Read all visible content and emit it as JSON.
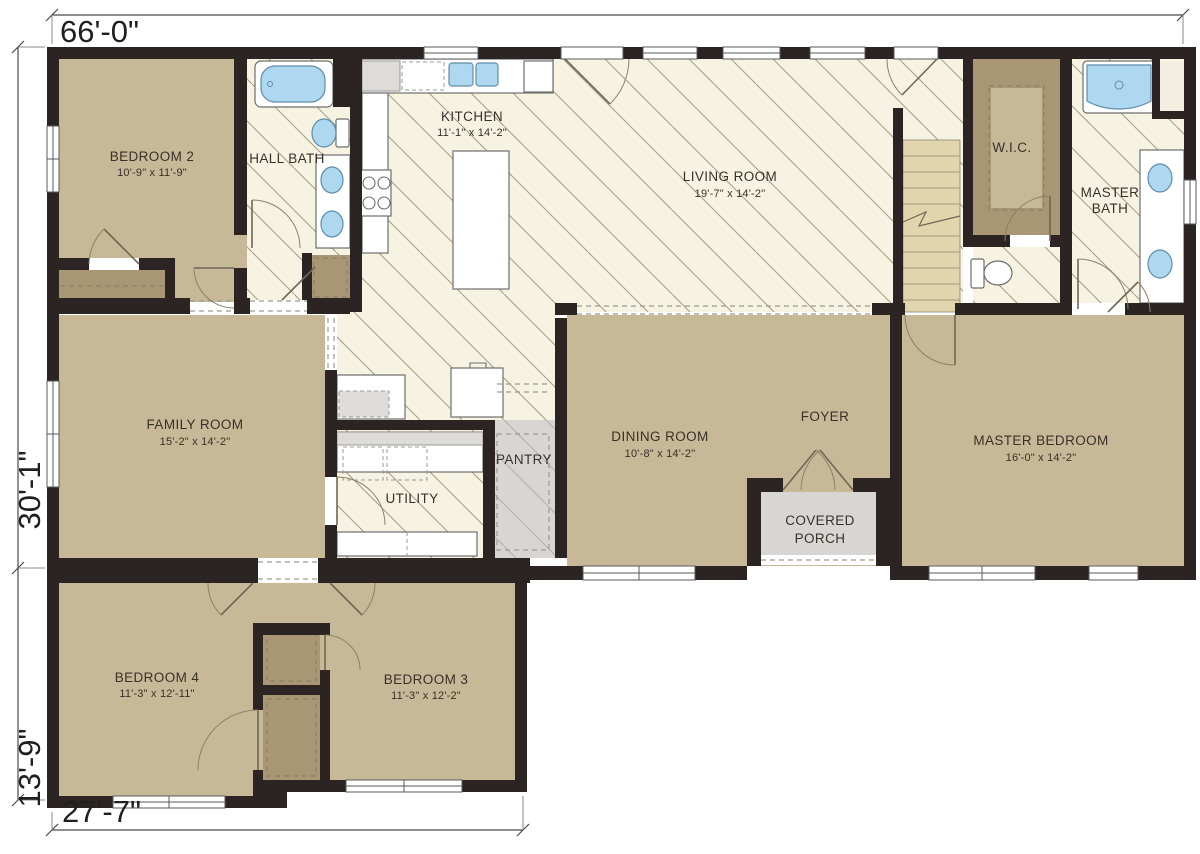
{
  "plan": {
    "dimensions": {
      "overall_width": "66'-0\"",
      "main_depth": "30'-1\"",
      "wing_depth": "13'-9\"",
      "wing_width": "27'-7\""
    },
    "rooms": {
      "bedroom2": {
        "label": "BEDROOM 2",
        "size": "10'-9\" x 11'-9\""
      },
      "hall_bath": {
        "label": "HALL BATH"
      },
      "kitchen": {
        "label": "KITCHEN",
        "size": "11'-1\" x 14'-2\""
      },
      "living_room": {
        "label": "LIVING ROOM",
        "size": "19'-7\" x 14'-2\""
      },
      "wic": {
        "label": "W.I.C."
      },
      "master_bath": {
        "label_line1": "MASTER",
        "label_line2": "BATH"
      },
      "family_room": {
        "label": "FAMILY ROOM",
        "size": "15'-2\" x 14'-2\""
      },
      "dining_room": {
        "label": "DINING ROOM",
        "size": "10'-8\" x 14'-2\""
      },
      "foyer": {
        "label": "FOYER"
      },
      "utility": {
        "label": "UTILITY"
      },
      "pantry": {
        "label": "PANTRY"
      },
      "covered_porch": {
        "label_line1": "COVERED",
        "label_line2": "PORCH"
      },
      "master_bedroom": {
        "label": "MASTER BEDROOM",
        "size": "16'-0\" x 14'-2\""
      },
      "bedroom4": {
        "label": "BEDROOM 4",
        "size": "11'-3\" x 12'-11\""
      },
      "bedroom3": {
        "label": "BEDROOM 3",
        "size": "11'-3\" x 12'-2\""
      }
    },
    "colors": {
      "wall": "#2b2422",
      "room_tan": "#c7b897",
      "closet_tan": "#a89674",
      "floor_cream": "#f7f3e3",
      "hatch_line": "#a49d85",
      "porch_gray": "#d7d6d2",
      "fixture_blue": "#aed7f0",
      "stair_tan": "#e2d5ad"
    }
  }
}
